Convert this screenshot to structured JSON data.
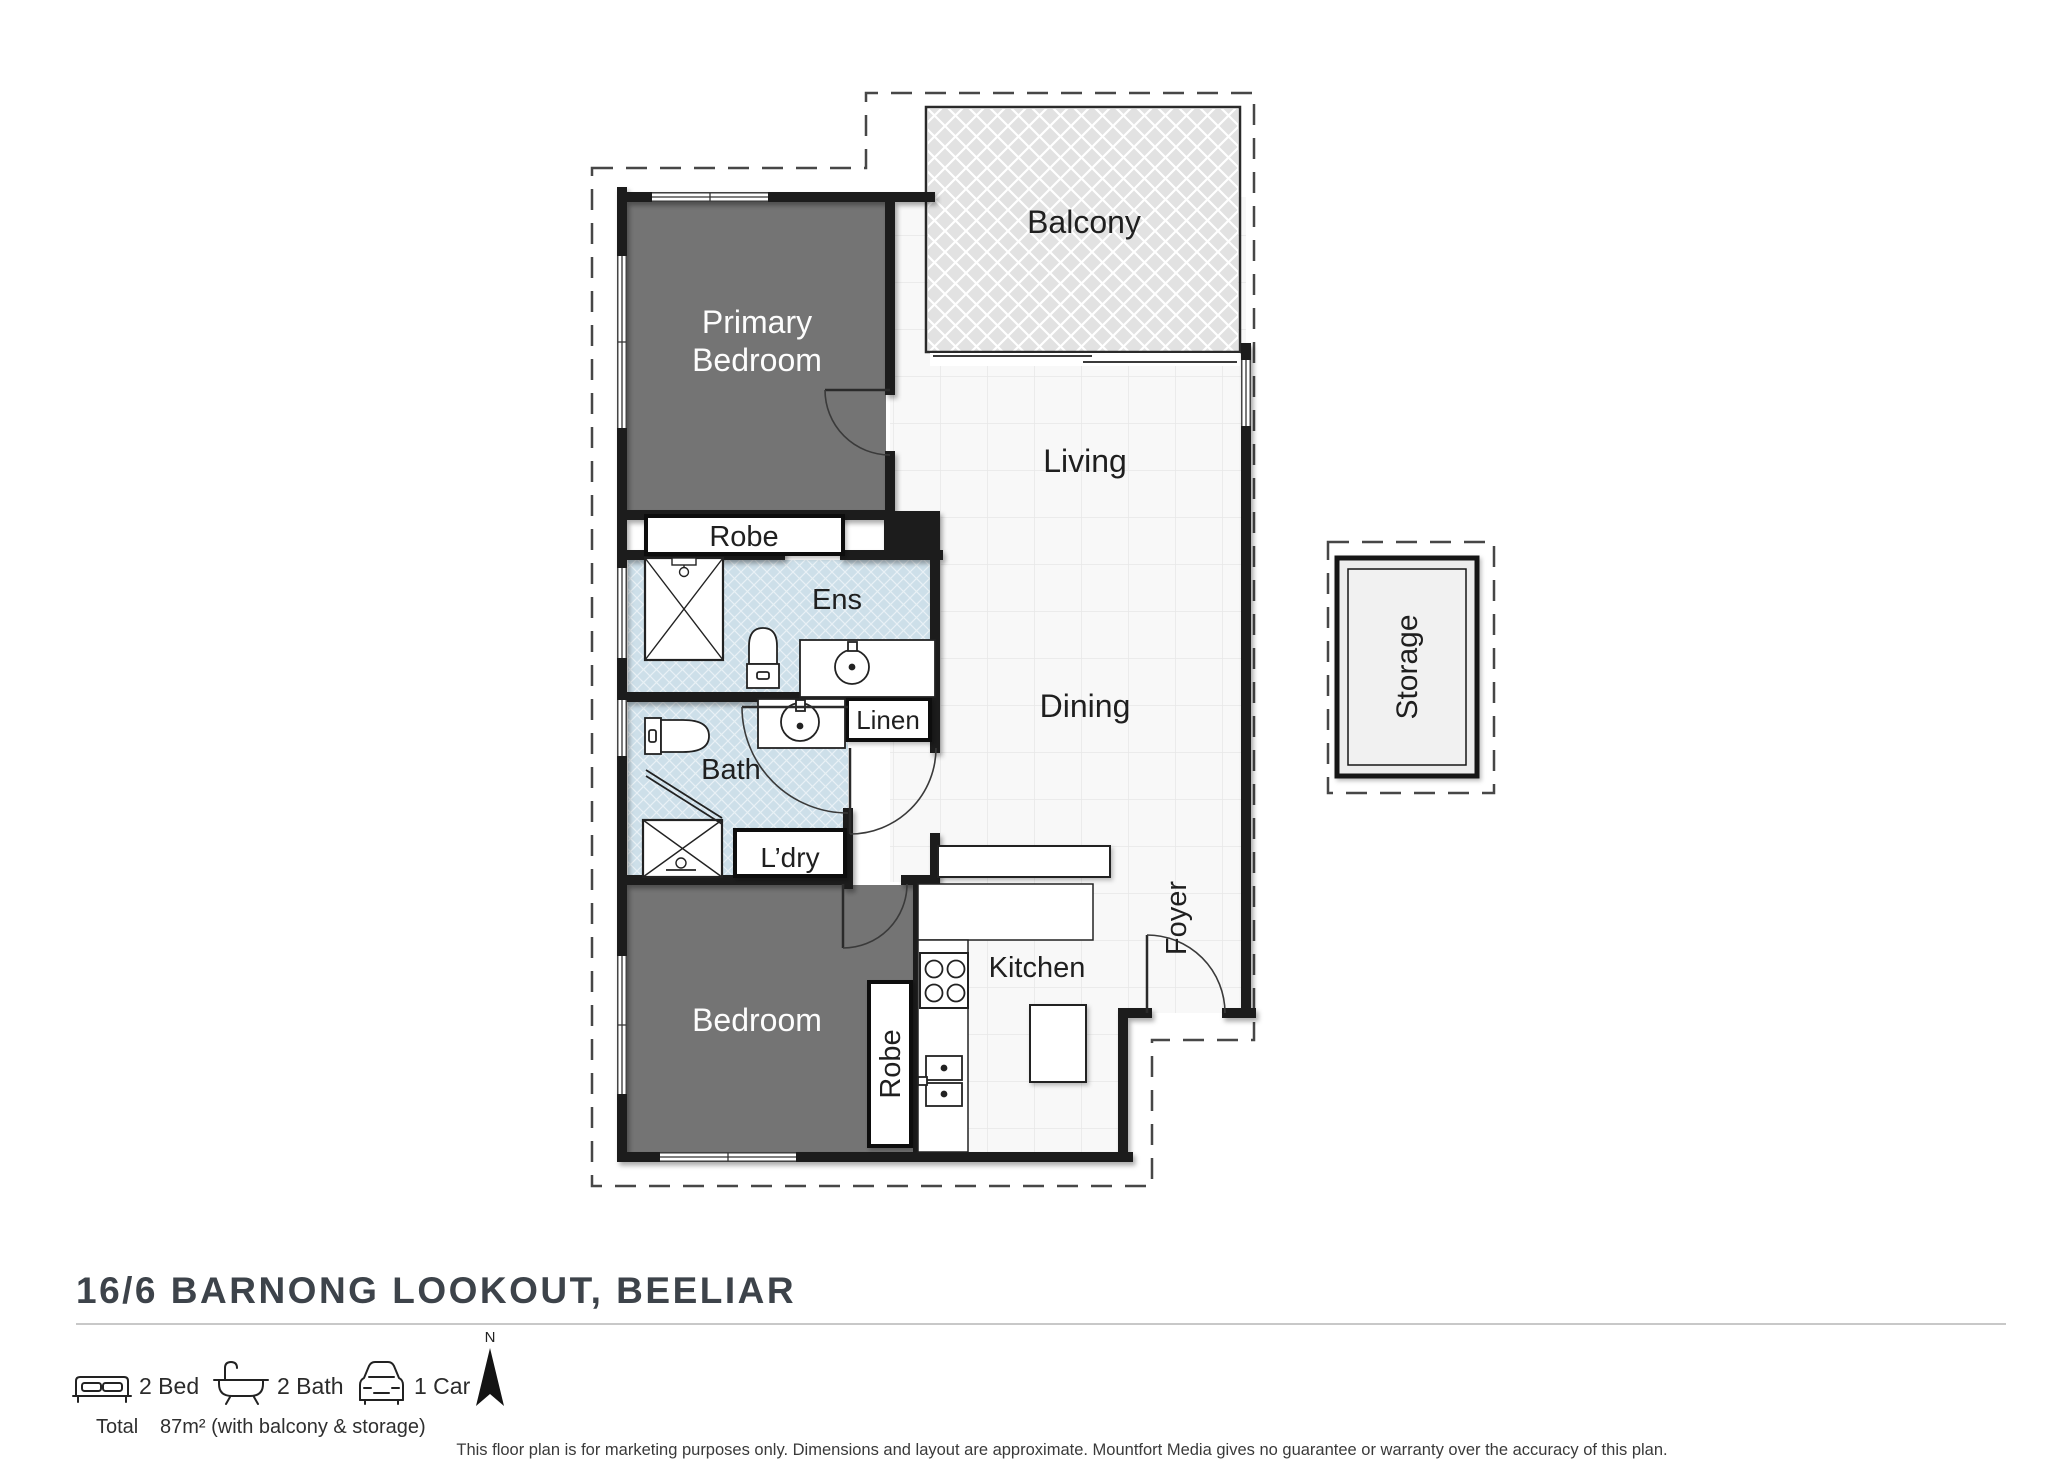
{
  "plan": {
    "rooms": {
      "balcony": {
        "label": "Balcony"
      },
      "primary_bedroom": {
        "line1": "Primary",
        "line2": "Bedroom"
      },
      "living": {
        "label": "Living"
      },
      "robe_primary": {
        "label": "Robe"
      },
      "ens": {
        "label": "Ens"
      },
      "linen": {
        "label": "Linen"
      },
      "dining": {
        "label": "Dining"
      },
      "bath": {
        "label": "Bath"
      },
      "laundry": {
        "label": "L’dry"
      },
      "bedroom": {
        "label": "Bedroom"
      },
      "robe_bedroom": {
        "label": "Robe"
      },
      "kitchen": {
        "label": "Kitchen"
      },
      "foyer": {
        "label": "Foyer"
      },
      "storage": {
        "label": "Storage"
      }
    },
    "colors": {
      "wall": "#1d1d1d",
      "bedroom_fill": "#747474",
      "wet_area_fill": "#cddfe9",
      "balcony_fill": "#e2e2e2",
      "tile_line": "#e7e7e7"
    }
  },
  "footer": {
    "title": "16/6 BARNONG LOOKOUT, BEELIAR",
    "features": [
      {
        "icon": "bed-icon",
        "label": "2 Bed"
      },
      {
        "icon": "bath-icon",
        "label": "2 Bath"
      },
      {
        "icon": "car-icon",
        "label": "1 Car"
      }
    ],
    "compass_label": "N",
    "total_label": "Total",
    "total_value": "87m² (with balcony & storage)",
    "disclaimer": "This floor plan is for marketing purposes only. Dimensions and layout are approximate. Mountfort Media gives no guarantee or warranty over the accuracy of this plan."
  }
}
